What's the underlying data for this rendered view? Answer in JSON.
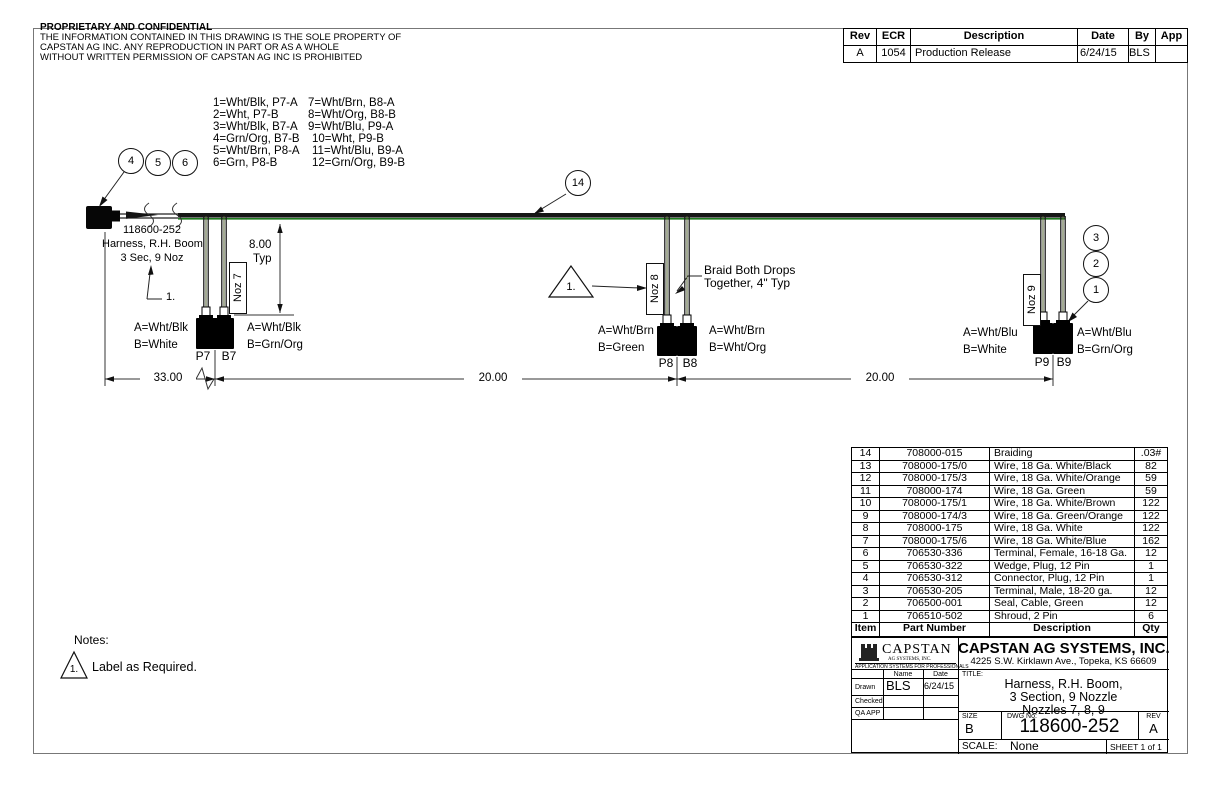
{
  "proprietary": {
    "title": "PROPRIETARY AND CONFIDENTIAL",
    "line1": "THE INFORMATION CONTAINED IN THIS DRAWING IS THE SOLE PROPERTY OF",
    "line2": "CAPSTAN AG INC. ANY REPRODUCTION IN PART OR AS A WHOLE",
    "line3": "WITHOUT WRITTEN PERMISSION OF CAPSTAN AG INC IS PROHIBITED"
  },
  "revision_table": {
    "headers": [
      "Rev",
      "ECR",
      "Description",
      "Date",
      "By",
      "App"
    ],
    "rows": [
      [
        "A",
        "1054",
        "Production Release",
        "6/24/15",
        "BLS",
        ""
      ]
    ]
  },
  "wire_legend": {
    "col1": [
      "1=Wht/Blk, P7-A",
      "2=Wht, P7-B",
      "3=Wht/Blk, B7-A",
      "4=Grn/Org, B7-B",
      "5=Wht/Brn, P8-A",
      "6=Grn, P8-B"
    ],
    "col2": [
      "7=Wht/Brn, B8-A",
      "8=Wht/Org, B8-B",
      "9=Wht/Blu, P9-A",
      "10=Wht, P9-B",
      "11=Wht/Blu, B9-A",
      "12=Grn/Org, B9-B"
    ]
  },
  "diagram": {
    "balloons": {
      "left": [
        "4",
        "5",
        "6"
      ],
      "mid": "14",
      "right": [
        "3",
        "2",
        "1"
      ]
    },
    "triangle_marker": "1.",
    "label_note_marker": "1.",
    "harness_label": [
      "118600-252",
      "Harness, R.H. Boom",
      "3 Sec, 9 Noz"
    ],
    "braid_note": [
      "Braid Both Drops",
      "Together, 4\" Typ"
    ],
    "noz_labels": [
      "Noz 7",
      "Noz 8",
      "Noz 9"
    ],
    "dims": {
      "drop": "8.00",
      "drop_typ": "Typ",
      "d33": "33.00",
      "d20a": "20.00",
      "d20b": "20.00"
    },
    "nozzle7": {
      "left_a": "A=Wht/Blk",
      "left_b": "B=White",
      "plug": "P7",
      "boom": "B7",
      "right_a": "A=Wht/Blk",
      "right_b": "B=Grn/Org"
    },
    "nozzle8": {
      "left_a": "A=Wht/Brn",
      "left_b": "B=Green",
      "plug": "P8",
      "boom": "B8",
      "right_a": "A=Wht/Brn",
      "right_b": "B=Wht/Org"
    },
    "nozzle9": {
      "left_a": "A=Wht/Blu",
      "left_b": "B=White",
      "plug": "P9",
      "boom": "B9",
      "right_a": "A=Wht/Blu",
      "right_b": "B=Grn/Org"
    }
  },
  "notes": {
    "title": "Notes:",
    "note1_marker": "1.",
    "note1_text": "Label as Required."
  },
  "parts_table": {
    "headers": [
      "Item",
      "Part Number",
      "Description",
      "Qty"
    ],
    "rows": [
      [
        "14",
        "708000-015",
        "Braiding",
        ".03#"
      ],
      [
        "13",
        "708000-175/0",
        "Wire, 18 Ga. White/Black",
        "82"
      ],
      [
        "12",
        "708000-175/3",
        "Wire, 18 Ga. White/Orange",
        "59"
      ],
      [
        "11",
        "708000-174",
        "Wire, 18 Ga. Green",
        "59"
      ],
      [
        "10",
        "708000-175/1",
        "Wire, 18 Ga. White/Brown",
        "122"
      ],
      [
        "9",
        "708000-174/3",
        "Wire, 18 Ga. Green/Orange",
        "122"
      ],
      [
        "8",
        "708000-175",
        "Wire, 18 Ga. White",
        "122"
      ],
      [
        "7",
        "708000-175/6",
        "Wire, 18 Ga. White/Blue",
        "162"
      ],
      [
        "6",
        "706530-336",
        "Terminal, Female, 16-18 Ga.",
        "12"
      ],
      [
        "5",
        "706530-322",
        "Wedge, Plug, 12 Pin",
        "1"
      ],
      [
        "4",
        "706530-312",
        "Connector, Plug, 12 Pin",
        "1"
      ],
      [
        "3",
        "706530-205",
        "Terminal, Male, 18-20 ga.",
        "12"
      ],
      [
        "2",
        "706500-001",
        "Seal, Cable, Green",
        "12"
      ],
      [
        "1",
        "706510-502",
        "Shroud, 2 Pin",
        "6"
      ]
    ]
  },
  "title_block": {
    "logo_name": "CAPSTAN",
    "logo_sub": "AG SYSTEMS, INC.",
    "logo_tagline": "APPLICATION SYSTEMS FOR PROFESSIONALS",
    "company": "CAPSTAN AG SYSTEMS, INC.",
    "address": "4225 S.W. Kirklawn Ave., Topeka, KS 66609",
    "name_header": "Name",
    "date_header": "Date",
    "drawn_label": "Drawn",
    "drawn_name": "BLS",
    "drawn_date": "6/24/15",
    "checked_label": "Checked",
    "qa_label": "QA APP",
    "title_label": "TITLE:",
    "title_l1": "Harness, R.H. Boom,",
    "title_l2": "3 Section, 9 Nozzle",
    "title_l3": "Nozzles 7, 8, 9",
    "size_label": "SIZE",
    "size": "B",
    "dwg_label": "DWG No:",
    "dwg_no": "118600-252",
    "rev_label": "REV",
    "rev": "A",
    "scale_label": "SCALE:",
    "scale": "None",
    "sheet": "SHEET 1 of 1"
  },
  "colors": {
    "wire_green": "#1E7A1E",
    "line": "#1A1A1A"
  }
}
